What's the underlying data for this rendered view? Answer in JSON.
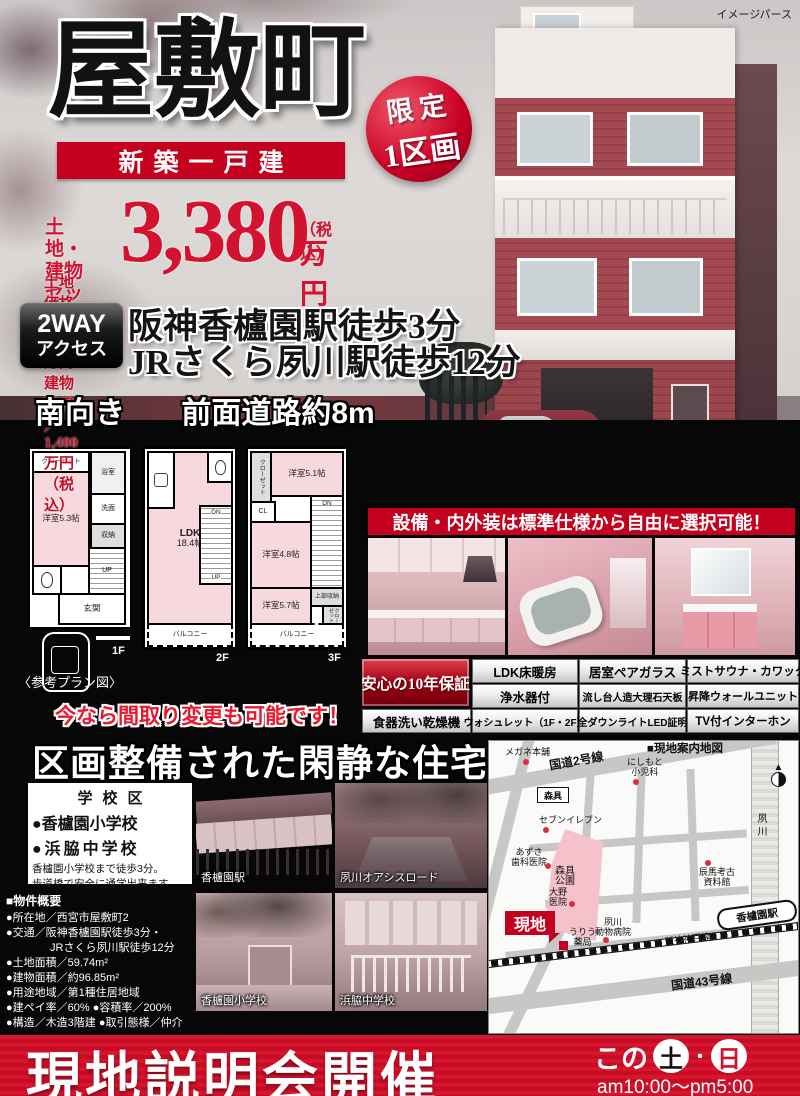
{
  "meta": {
    "note": "イメージパース"
  },
  "header": {
    "title": "屋敷町",
    "subtitle": "新築一戸建"
  },
  "badge": {
    "line1": "限定",
    "line2": "1区画"
  },
  "price": {
    "label1": "土地・建物",
    "label2": "セット価格",
    "amount": "3,380",
    "tax": "（税込）",
    "unit": "万円",
    "breakdown": "土地価格／1,980万円　建物価格／1,400万円（税込）"
  },
  "access": {
    "badge1": "2WAY",
    "badge2": "アクセス",
    "line1": "阪神香櫨園駅徒歩3分",
    "line2": "JRさくら夙川駅徒歩12分"
  },
  "facing": {
    "left": "南向き",
    "right": "前面道路約8m"
  },
  "plans": {
    "caption": "〈参考プラン図〉",
    "note": "今なら間取り変更も可能です！",
    "f1": {
      "label": "1F",
      "closet": "クローゼット",
      "bath": "浴室",
      "room": "洋室5.3帖",
      "wash": "洗面",
      "storage": "収納",
      "up": "UP",
      "entrance": "玄関"
    },
    "f2": {
      "label": "2F",
      "ldk": "LDK",
      "ldk_size": "18.4帖",
      "dn": "DN",
      "up": "UP",
      "balcony": "バルコニー"
    },
    "f3": {
      "label": "3F",
      "room1": "洋室5.1帖",
      "cl": "CL",
      "closet": "クローゼット",
      "room2": "洋室4.8帖",
      "dn": "DN",
      "upper": "上部収納",
      "room3": "洋室5.7帖",
      "closet2": "クローゼット",
      "balcony": "バルコニー"
    }
  },
  "equip": {
    "banner": "設備・内外装は標準仕様から自由に選択可能！",
    "warranty": "安心の10年保証",
    "r1": [
      "LDK床暖房",
      "居室ペアガラス",
      "ミストサウナ・カワック"
    ],
    "r2": [
      "浄水器付",
      "流し台人造大理石天板",
      "昇降ウォールユニット"
    ],
    "r3": [
      "食器洗い乾燥機",
      "ウォシュレット（1F・2F）",
      "全ダウンライトLED証明",
      "TV付インターホン"
    ]
  },
  "town": {
    "headline": "区画整備された閑静な住宅街！"
  },
  "school": {
    "title": "学校区",
    "item1": "●香櫨園小学校",
    "item2": "●浜脇中学校",
    "note1": "香櫨園小学校まで徒歩3分。",
    "note2": "歩道橋で安全に通学出来ます。"
  },
  "photos": {
    "station": "香櫨園駅",
    "oasis": "夙川オアシスロード",
    "elementary": "香櫨園小学校",
    "junior": "浜脇中学校"
  },
  "overview": {
    "title": "■物件概要",
    "items": [
      "●所在地／西宮市屋敷町2",
      "●交通／阪神香櫨園駅徒歩3分・",
      "　　　　JRさくら夙川駅徒歩12分",
      "●土地面積／59.74m²",
      "●建物面積／約96.85m²",
      "●用途地域／第1種住居地域",
      "●建ペイ率／60% ●容積率／200%",
      "●構造／木造3階建 ●取引態様／仲介"
    ]
  },
  "map": {
    "title": "■現地案内地図",
    "labels": {
      "megane": "メガネ本舗",
      "route2": "国道2号線",
      "nishimoto1": "にしもと",
      "nishimoto2": "小児科",
      "morigu": "森具",
      "seven": "セブンイレブン",
      "azusa1": "あずさ",
      "azusa2": "歯科医院",
      "park1": "森具",
      "park2": "公園",
      "tatsuuma1": "辰馬考古",
      "tatsuuma2": "資料館",
      "river": "夙川",
      "ohno1": "大野",
      "ohno2": "医院",
      "genchi": "現地",
      "uriu1": "うりう",
      "uriu2": "薬局",
      "animal1": "夙川",
      "animal2": "動物病院",
      "hanshin": "阪神神戸線",
      "station": "香櫨園駅",
      "route43": "国道43号線"
    }
  },
  "footer": {
    "headline": "現地説明会開催",
    "kono": "この",
    "sat": "土",
    "dot": "・",
    "sun": "日",
    "time": "am10:00～pm5:00"
  }
}
